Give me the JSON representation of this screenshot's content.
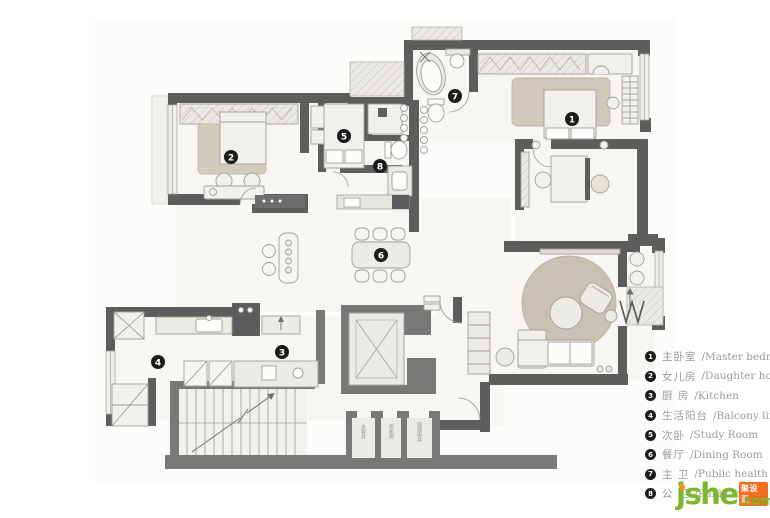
{
  "legend": {
    "items": [
      {
        "num": "1",
        "zh": "主卧室",
        "en": "/Master bedroom"
      },
      {
        "num": "2",
        "zh": "女儿房",
        "en": "/Daughter house"
      },
      {
        "num": "3",
        "zh": "厨 房",
        "en": "/Kitchen"
      },
      {
        "num": "4",
        "zh": "生活阳台",
        "en": "/Balcony life"
      },
      {
        "num": "5",
        "zh": "次卧",
        "en": "/Study Room"
      },
      {
        "num": "6",
        "zh": "餐厅",
        "en": "/Dining Room"
      },
      {
        "num": "7",
        "zh": "主 卫",
        "en": "/Public health"
      },
      {
        "num": "8",
        "zh": "公 卫",
        "en": "/Public health"
      }
    ]
  },
  "plan": {
    "badges": [
      "1",
      "2",
      "3",
      "4",
      "5",
      "6",
      "7",
      "8"
    ],
    "shaft_labels": [
      "水管井",
      "风机房",
      "强弱电井"
    ]
  },
  "logo": {
    "name": "jsheh",
    "tld": ".com",
    "tag": "聚设汇"
  },
  "colors": {
    "wall": "#5d5d5d",
    "core_wall": "#7a7a7a",
    "floor": "#f7f6f2",
    "rug": "#c8c2b4",
    "badge": "#1c1c1c",
    "legend_text": "#9b9b9b",
    "logo_green": "#7cb82f",
    "logo_orange": "#f26f21"
  }
}
